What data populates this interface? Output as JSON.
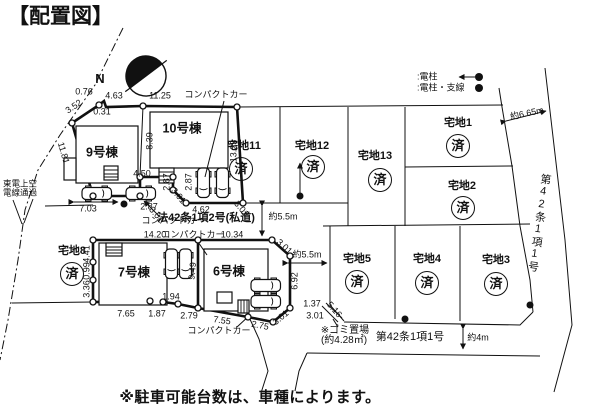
{
  "title": "【配置図】",
  "compass_label": "N",
  "legend": {
    "pole": ":電柱",
    "pole_guy": ":電柱・支線"
  },
  "overhead_note": {
    "line1": "東電上空",
    "line2": "電線通過"
  },
  "buildings": {
    "b9": "9号棟",
    "b10": "10号棟",
    "b7": "7号棟",
    "b6": "6号棟"
  },
  "lots": {
    "lot11": {
      "name": "宅地11",
      "status": "済"
    },
    "lot12": {
      "name": "宅地12",
      "status": "済"
    },
    "lot13": {
      "name": "宅地13",
      "status": "済"
    },
    "lot1": {
      "name": "宅地1",
      "status": "済"
    },
    "lot2": {
      "name": "宅地2",
      "status": "済"
    },
    "lot8": {
      "name": "宅地8",
      "status": "済"
    },
    "lot5": {
      "name": "宅地5",
      "status": "済"
    },
    "lot4": {
      "name": "宅地4",
      "status": "済"
    },
    "lot3": {
      "name": "宅地3",
      "status": "済"
    }
  },
  "roads": {
    "private": "法42条1項2号(私道)",
    "south": "第42条1項1号",
    "east": "第42条1項1号"
  },
  "widths": {
    "east": "約6.65m",
    "private_vertical": "約5.5m",
    "private_horizontal": "約5.5m",
    "south": "約4m"
  },
  "garbage_note": {
    "line1": "※ゴミ置場",
    "line2": "(約4.28㎡)"
  },
  "parking_note": "※駐車可能台数は、車種によります。",
  "compact_car_label": "コンパクトカー",
  "dims": [
    "0.76",
    "3.52",
    "0.31",
    "4.63",
    "11.25",
    "11.81",
    "8.39",
    "13.23",
    "4.50",
    "2.87",
    "2.87",
    "3.01",
    "3.01",
    "3.01",
    "4.62",
    "7.03",
    "2.87",
    "14.20",
    "10.34",
    "4.41",
    "0.99",
    "3.36",
    "9.49",
    "7.65",
    "1.87",
    "1.94",
    "2.79",
    "7.55",
    "2.75",
    "3.01",
    "6.92",
    "3.01",
    "1.37",
    "3.01",
    "5.16"
  ]
}
